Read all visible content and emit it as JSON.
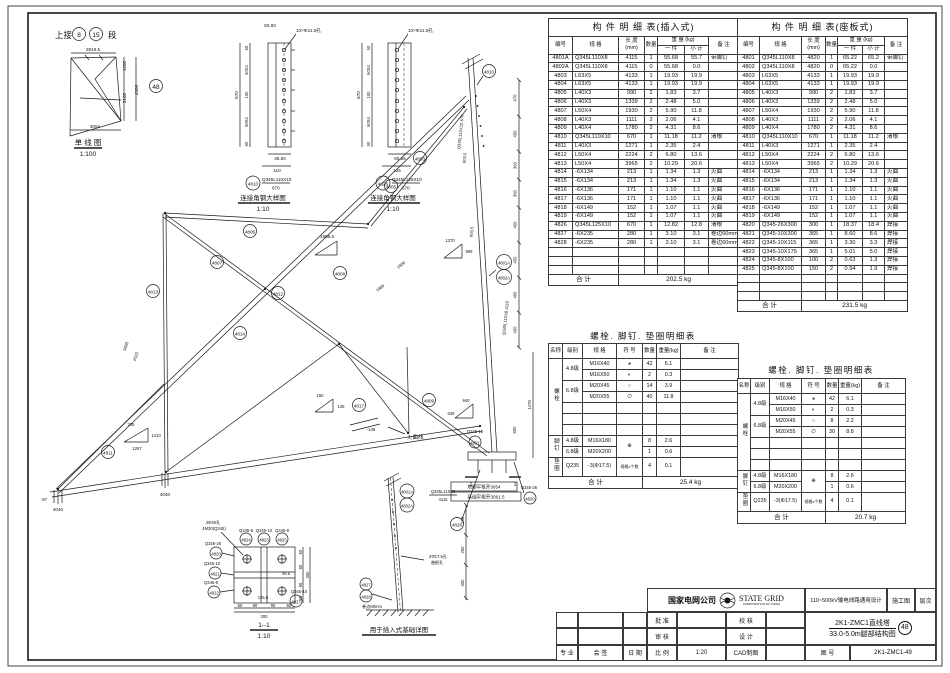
{
  "tables": {
    "headers": {
      "no": "编号",
      "spec": "规  格",
      "len1": "长 度",
      "len2": "(mm)",
      "qty": "数量",
      "weight": "重  量 (kg)",
      "one": "一 件",
      "sub": "小 计",
      "note": "备    注"
    },
    "insert": {
      "title": "构  件  明  细  表(插入式)",
      "rows": [
        [
          "4801A",
          "Q345L110X8",
          "4115",
          "1",
          "55.68",
          "55.7",
          "带脚钉"
        ],
        [
          "4802A",
          "Q345L110X8",
          "4115",
          "0",
          "55.68",
          "0.0",
          ""
        ],
        [
          "4803",
          "L63X5",
          "4133",
          "1",
          "19.93",
          "19.9",
          ""
        ],
        [
          "4804",
          "L63X5",
          "4133",
          "1",
          "19.93",
          "19.9",
          ""
        ],
        [
          "4805",
          "L40X3",
          "990",
          "2",
          "1.83",
          "3.7",
          ""
        ],
        [
          "4806",
          "L40X3",
          "1339",
          "2",
          "2.48",
          "5.0",
          ""
        ],
        [
          "4807",
          "L50X4",
          "1930",
          "2",
          "5.90",
          "11.8",
          ""
        ],
        [
          "4808",
          "L40X3",
          "1111",
          "2",
          "2.06",
          "4.1",
          ""
        ],
        [
          "4809",
          "L40X4",
          "1780",
          "2",
          "4.31",
          "8.6",
          ""
        ],
        [
          "4810",
          "Q345L110X10",
          "670",
          "1",
          "11.18",
          "11.2",
          "清根"
        ],
        [
          "4811",
          "L40X3",
          "1271",
          "1",
          "2.35",
          "2.4",
          ""
        ],
        [
          "4812",
          "L50X4",
          "2224",
          "2",
          "6.80",
          "13.6",
          ""
        ],
        [
          "4813",
          "L50X4",
          "3965",
          "2",
          "10.29",
          "20.6",
          ""
        ],
        [
          "4814",
          "-6X134",
          "213",
          "1",
          "1.34",
          "1.3",
          "火曲"
        ],
        [
          "4815",
          "-6X134",
          "213",
          "1",
          "1.34",
          "1.3",
          "火曲"
        ],
        [
          "4816",
          "-6X136",
          "171",
          "1",
          "1.10",
          "1.1",
          "火曲"
        ],
        [
          "4817",
          "-6X136",
          "171",
          "1",
          "1.10",
          "1.1",
          "火曲"
        ],
        [
          "4818",
          "-6X149",
          "152",
          "1",
          "1.07",
          "1.1",
          "火曲"
        ],
        [
          "4819",
          "-6X149",
          "152",
          "1",
          "1.07",
          "1.1",
          "火曲"
        ],
        [
          "4826",
          "Q345L125X10",
          "670",
          "1",
          "12.82",
          "12.8",
          "清根"
        ],
        [
          "4827",
          "-6X235",
          "280",
          "1",
          "3.10",
          "3.1",
          "卷边60mm"
        ],
        [
          "4828",
          "-6X235",
          "280",
          "1",
          "3.10",
          "3.1",
          "卷边60mm"
        ],
        [
          "",
          "",
          "",
          "",
          "",
          "",
          ""
        ],
        [
          "",
          "",
          "",
          "",
          "",
          "",
          ""
        ],
        [
          "",
          "",
          "",
          "",
          "",
          "",
          ""
        ]
      ],
      "total_label": "合    计",
      "total": "202.5 kg"
    },
    "seat": {
      "title": "构  件  明  细  表(座板式)",
      "rows": [
        [
          "4801",
          "Q345L110X8",
          "4820",
          "1",
          "65.22",
          "65.2",
          "带脚钉"
        ],
        [
          "4802",
          "Q345L110X8",
          "4820",
          "0",
          "65.22",
          "0.0",
          ""
        ],
        [
          "4803",
          "L63X5",
          "4133",
          "1",
          "19.93",
          "19.9",
          ""
        ],
        [
          "4804",
          "L63X5",
          "4133",
          "1",
          "19.93",
          "19.9",
          ""
        ],
        [
          "4805",
          "L40X3",
          "990",
          "2",
          "1.83",
          "3.7",
          ""
        ],
        [
          "4806",
          "L40X3",
          "1339",
          "2",
          "2.48",
          "5.0",
          ""
        ],
        [
          "4807",
          "L50X4",
          "1930",
          "2",
          "5.90",
          "11.8",
          ""
        ],
        [
          "4808",
          "L40X3",
          "1111",
          "2",
          "2.06",
          "4.1",
          ""
        ],
        [
          "4809",
          "L40X4",
          "1780",
          "2",
          "4.31",
          "8.6",
          ""
        ],
        [
          "4810",
          "Q345L110X10",
          "670",
          "1",
          "11.18",
          "11.2",
          "清根"
        ],
        [
          "4811",
          "L40X3",
          "1271",
          "1",
          "2.35",
          "2.4",
          ""
        ],
        [
          "4812",
          "L50X4",
          "2224",
          "2",
          "6.80",
          "13.6",
          ""
        ],
        [
          "4813",
          "L50X4",
          "3965",
          "2",
          "10.29",
          "20.6",
          ""
        ],
        [
          "4814",
          "-6X134",
          "213",
          "1",
          "1.34",
          "1.3",
          "火曲"
        ],
        [
          "4815",
          "-6X134",
          "213",
          "1",
          "1.34",
          "1.3",
          "火曲"
        ],
        [
          "4816",
          "-6X136",
          "171",
          "1",
          "1.10",
          "1.1",
          "火曲"
        ],
        [
          "4817",
          "-6X136",
          "171",
          "1",
          "1.10",
          "1.1",
          "火曲"
        ],
        [
          "4818",
          "-6X149",
          "152",
          "1",
          "1.07",
          "1.1",
          "火曲"
        ],
        [
          "4819",
          "-6X149",
          "152",
          "1",
          "1.07",
          "1.1",
          "火曲"
        ],
        [
          "4820",
          "Q345-26X300",
          "300",
          "1",
          "18.37",
          "18.4",
          "焊接"
        ],
        [
          "4821",
          "Q345-10X300",
          "365",
          "1",
          "8.60",
          "8.6",
          "焊接"
        ],
        [
          "4822",
          "Q345-10X115",
          "365",
          "1",
          "3.30",
          "3.3",
          "焊接"
        ],
        [
          "4823",
          "Q345-10X175",
          "365",
          "1",
          "5.01",
          "5.0",
          "焊接"
        ],
        [
          "4824",
          "Q345-8X100",
          "100",
          "2",
          "0.63",
          "1.3",
          "焊接"
        ],
        [
          "4825",
          "Q345-8X100",
          "150",
          "2",
          "0.94",
          "1.9",
          "焊接"
        ],
        [
          "",
          "",
          "",
          "",
          "",
          "",
          ""
        ],
        [
          "",
          "",
          "",
          "",
          "",
          "",
          ""
        ],
        [
          "",
          "",
          "",
          "",
          "",
          "",
          ""
        ]
      ],
      "total_label": "合    计",
      "total": "231.5 kg"
    }
  },
  "bolts": {
    "title": "螺栓. 脚钉. 垫圈明细表",
    "headers": {
      "name": "名称",
      "grade": "级别",
      "spec": "规  格",
      "symbol": "符 号",
      "qty": "数量",
      "weight": "重量(kg)",
      "note": "备    注"
    },
    "bolt_group": "螺栓",
    "foot_group": "脚钉",
    "washer_group": "垫圈",
    "g48": "4.8级",
    "g68": "6.8级",
    "q235": "Q235",
    "specs": {
      "r1": "M16X40",
      "r2": "M16X50",
      "r3": "M20X45",
      "r4": "M20X55",
      "f1": "M16X180",
      "f2": "M20X200",
      "w": "-3(Φ17.5)"
    },
    "symbols": {
      "r1": "◕",
      "r2": "◐",
      "r3": "○",
      "r4": "∅",
      "foot": "⊕",
      "washer": "规格x个数"
    },
    "total_label": "合      计",
    "left": {
      "q1": "42",
      "w1": "6.1",
      "q2": "2",
      "w2": "0.3",
      "q3": "14",
      "w3": "3.9",
      "q4": "40",
      "w4": "11.8",
      "f1q": "8",
      "f1w": "2.6",
      "f2q": "1",
      "f2w": "0.6",
      "wq": "4",
      "ww": "0.1",
      "total": "25.4 kg"
    },
    "right": {
      "q1": "42",
      "w1": "6.1",
      "q2": "2",
      "w2": "0.3",
      "q3": "8",
      "w3": "2.2",
      "q4": "30",
      "w4": "8.8",
      "f1q": "8",
      "f1w": "2.6",
      "f2q": "1",
      "f2w": "0.6",
      "wq": "4",
      "ww": "0.1",
      "total": "20.7 kg"
    }
  },
  "titleblock": {
    "company": "国家电网公司",
    "brand": "STATE GRID",
    "brand_sub": "CORPORATION OF CHINA",
    "project": "110~500kV输电线路通用设计",
    "stage": "施工图",
    "sheet": "层次",
    "approve": "批 准",
    "check": "校 核",
    "review": "审 核",
    "design": "设 计",
    "scale_label": "比 例",
    "scale": "1:20",
    "cad": "CAD制图",
    "title1": "2K1-ZMC1直线塔",
    "title2": "33.0-5.0m腿部结构图",
    "circ": "48",
    "dno_label": "图 号",
    "dno": "2K1-ZMC1-49",
    "prof": "专 业",
    "sign": "会 签",
    "date": "日 期"
  },
  "drawing": {
    "sld": {
      "connect": "上接",
      "c8": "8",
      "c15": "15",
      "duan": "段",
      "d2819": "2819.5",
      "d1200": "1200",
      "d3100": "3100",
      "d4300": "4300",
      "d3054": "3054",
      "c48": "48",
      "title": "单 线 图",
      "scale": "1:100"
    },
    "det1": {
      "holes": "10×Φ21.5孔",
      "top": "50,60",
      "s50a": "50",
      "s60a": "60X4",
      "s100": "100",
      "s60b": "60X4",
      "s50b": "50",
      "total": "670",
      "b1": "45,60",
      "b2": "110",
      "callout": "4810",
      "spec": "Q345L110X10",
      "len": "670",
      "title": "连接角钢大样图",
      "scale": "1:10"
    },
    "det2": {
      "holes": "10×Φ21.5孔",
      "s50a": "50",
      "s60a": "60X4",
      "s100": "100",
      "s60b": "60X4",
      "s50b": "50",
      "total": "670",
      "b1": "60,65",
      "b2": "125",
      "callout": "4826",
      "spec": "Q345L125X10",
      "len": "670",
      "title": "连接角钢大样图",
      "scale": "1:10"
    },
    "truss": {
      "c4810": "4810",
      "c4801a": "4801A",
      "c4802a": "4802A",
      "c4803": "4803",
      "c4805": "4805",
      "c4806": "4806",
      "c4807": "4807",
      "c4808": "4808",
      "c4809": "4809",
      "c4811": "4811",
      "c4812": "4812",
      "c4813": "4813",
      "c4814": "4814",
      "c4817": "4817",
      "c4820": "4820",
      "c4821": "4821",
      "c4826": "4826",
      "q26": "Q345-26",
      "q10": "Q345-10",
      "d1869": "1869.5",
      "d1370": "1370",
      "d999": "999",
      "d205": "205",
      "d1410": "1410",
      "d1267": "1267",
      "d150": "150",
      "d145": "145",
      "d940": "940",
      "d639": "639",
      "d1898": "1898",
      "d2025": "2025",
      "d1800": "1800",
      "d1880": "1880",
      "d603a": "603.5",
      "d603b": "603.5",
      "spec_top": "Q345L110X10 670",
      "spec_leg": "Q345L110X8 4115",
      "chain": [
        "470",
        "450",
        "360",
        "360",
        "450",
        "450",
        "450",
        "450"
      ],
      "d1479": "1479",
      "d600": "600",
      "huoqu": "火曲线",
      "dm138": "-138",
      "dm87": "-87",
      "f4040a": "4040",
      "f4040b": "4040",
      "foot1": "塔脚平根开3054",
      "foot2": "基础平根开3061.5",
      "sec1": "1"
    },
    "sect": {
      "t4phi": "4Φ40孔",
      "t4m30": "4M30(Q345)",
      "sq26": "Q345-26",
      "sq10": "Q345-10",
      "sq8": "Q345-8",
      "c4820": "4820",
      "c4821": "4821",
      "c4822": "4822",
      "c4823": "4823",
      "c4824": "4824",
      "c4825": "4825",
      "c4827": "4827",
      "d60": "60",
      "d90": "90",
      "d300": "300",
      "d1255": "125.5",
      "d365": "36.5",
      "title": "1--1",
      "scale": "1:10"
    },
    "found": {
      "c1": "4801A",
      "c2": "4802A",
      "spec": "Q345L110X8",
      "len": "4115",
      "c4827": "4827",
      "c4828": "4828",
      "hole1": "2Φ17.5孔",
      "hole2": "避根孔",
      "roll": "卷边60mm",
      "d150": "150",
      "d250": "250",
      "d300": "300",
      "title": "用于插入式基础详图"
    }
  }
}
